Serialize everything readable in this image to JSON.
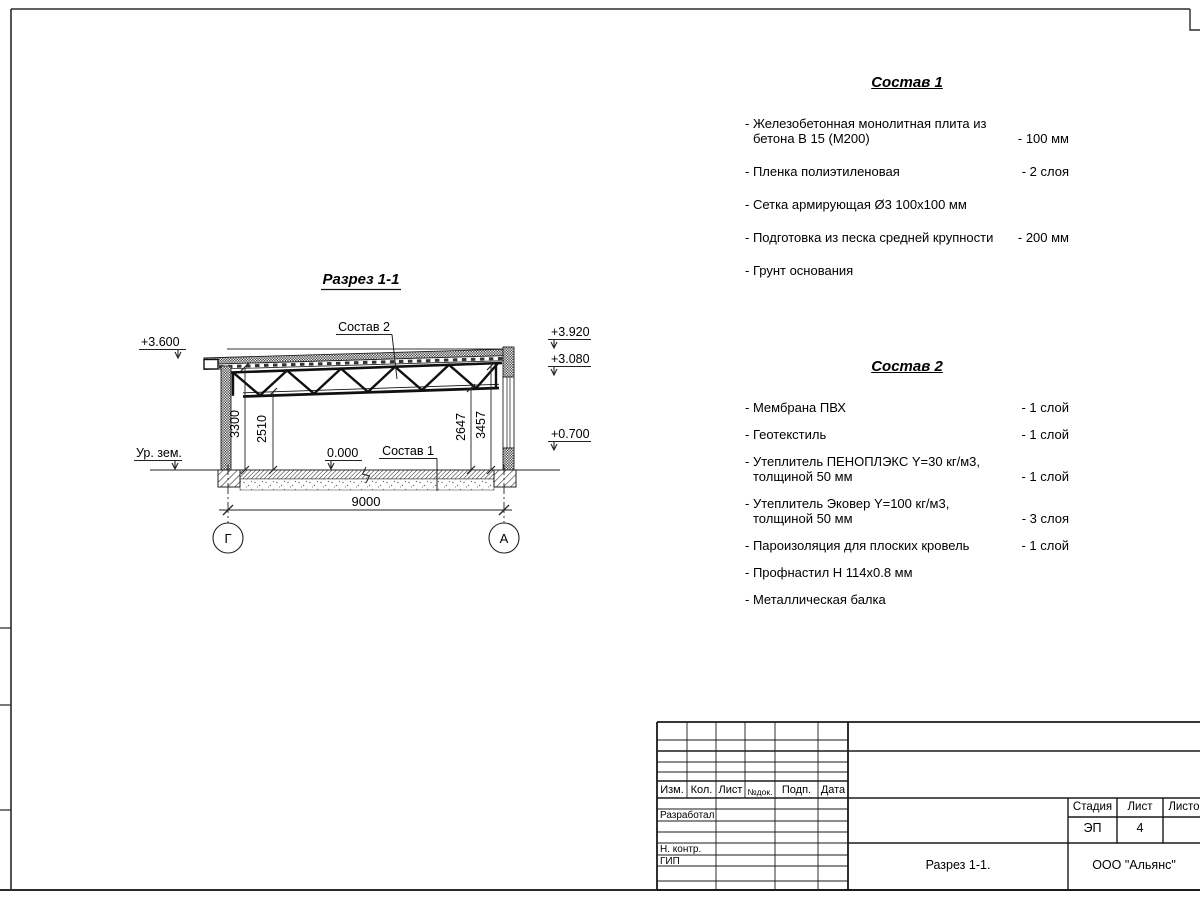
{
  "drawing": {
    "title": "Разрез 1-1",
    "labels": {
      "sostav2_ref": "Состав 2",
      "sostav1_ref": "Состав 1",
      "ground_level": "Ур. зем."
    },
    "elevations": {
      "left_top": "+3.600",
      "right_top": "+3.920",
      "right_mid": "+3.080",
      "right_low": "+0.700",
      "zero": "0.000"
    },
    "dimensions": {
      "span": "9000",
      "left_clear": "3300",
      "left_truss": "2510",
      "right_truss": "2647",
      "right_clear": "3457"
    },
    "axes": {
      "left": "Г",
      "right": "А"
    }
  },
  "sostav1": {
    "title": "Состав 1",
    "items": [
      {
        "name": "- Железобетонная  монолитная плита из бетона В 15 (М200)",
        "value": "- 100 мм"
      },
      {
        "name": "- Пленка полиэтиленовая",
        "value": "-  2 слоя"
      },
      {
        "name": "- Сетка армирующая Ø3 100х100 мм",
        "value": ""
      },
      {
        "name": "- Подготовка из песка средней крупности",
        "value": "- 200 мм"
      },
      {
        "name": "- Грунт основания",
        "value": ""
      }
    ]
  },
  "sostav2": {
    "title": "Состав 2",
    "items": [
      {
        "name": "- Мембрана ПВХ",
        "value": "- 1 слой"
      },
      {
        "name": "- Геотекстиль",
        "value": "- 1 слой"
      },
      {
        "name": "- Утеплитель ПЕНОПЛЭКС Y=30 кг/м3, толщиной 50 мм",
        "value": "- 1 слой"
      },
      {
        "name": "- Утеплитель Эковер Y=100 кг/м3, толщиной 50 мм",
        "value": "- 3 слоя"
      },
      {
        "name": "- Пароизоляция для плоских кровель",
        "value": "- 1 слой"
      },
      {
        "name": "- Профнастил Н 114х0.8 мм",
        "value": ""
      },
      {
        "name": "- Металлическая балка",
        "value": ""
      }
    ]
  },
  "titleblock": {
    "columns": {
      "izm": "Изм.",
      "kol": "Кол.",
      "list": "Лист",
      "ndok": "№док.",
      "podp": "Подп.",
      "data": "Дата"
    },
    "roles": {
      "developed": "Разработал",
      "ncontr": "Н. контр.",
      "gip": "ГИП"
    },
    "stage_label": "Стадия",
    "sheet_label": "Лист",
    "sheets_label": "Листов",
    "stage_value": "ЭП",
    "sheet_value": "4",
    "doc_title": "Разрез 1-1.",
    "company": "ООО \"Альянс\""
  }
}
